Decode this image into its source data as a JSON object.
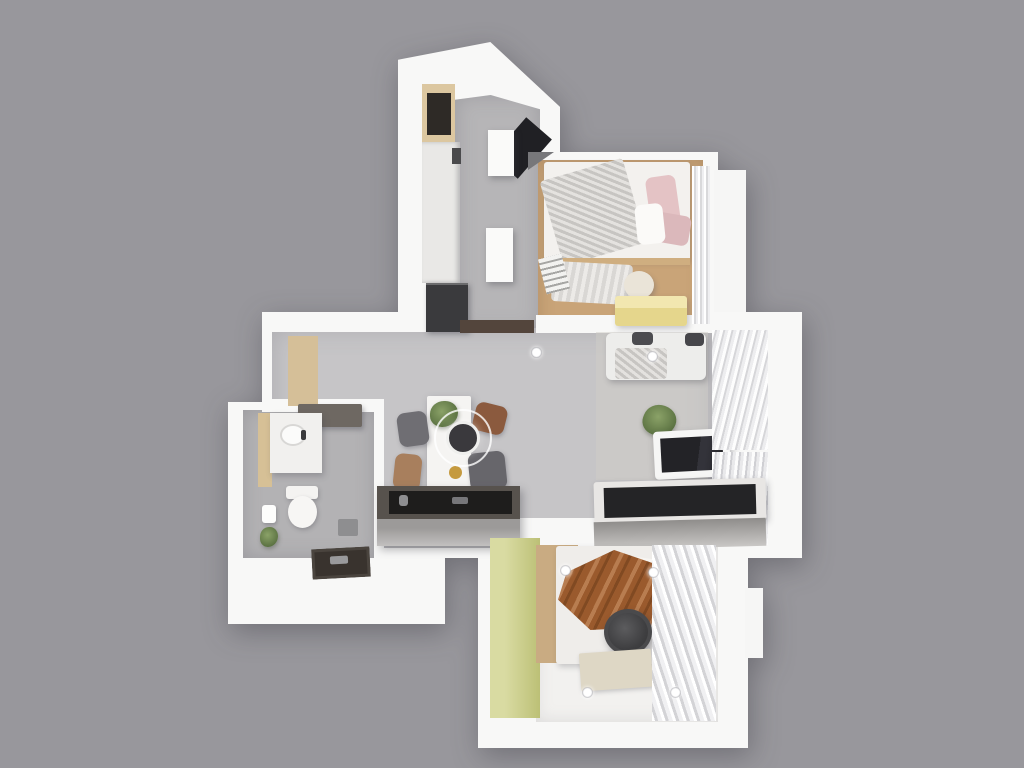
{
  "meta": {
    "type": "3d-floorplan-render",
    "description": "Top-down 3D render of a small apartment floor plan on a plain gray background",
    "canvas_width": 1024,
    "canvas_height": 768,
    "background_color": "#98979c"
  },
  "palette": {
    "background": "#98979c",
    "wall_white": "#f8f8f7",
    "floor_marble_gray": "#c6c5c7",
    "floor_marble_dark": "#b3b2b4",
    "floor_wood": "#c9a478",
    "floor_white_boards": "#f2f1ef",
    "accent_green_wall": "#bcc076",
    "accent_yellow_bench": "#e5d68c",
    "accent_pink_pillow": "#e4c3c5",
    "accent_brown_throw": "#9a5a2d",
    "dark_appliance": "#3a3a3d",
    "counter_dark_top": "#57524d",
    "gold_dish": "#c59a3f"
  },
  "rooms": [
    "kitchen",
    "bedroom-1",
    "living-dining",
    "entry",
    "bathroom",
    "bedroom-2"
  ],
  "scene": {
    "elements": [
      {
        "name": "kitchen-block",
        "rect": [
          398,
          42,
          162,
          295
        ],
        "bg": "#f8f8f7",
        "clip": "polygon(0 6%, 57% 0, 100% 22%, 100% 100%, 0 100%)"
      },
      {
        "name": "bedroom1-block",
        "rect": [
          528,
          152,
          190,
          188
        ],
        "bg": "#f8f8f7"
      },
      {
        "name": "bedroom1-side-step",
        "rect": [
          714,
          170,
          32,
          165
        ],
        "bg": "#f6f6f5"
      },
      {
        "name": "living-block",
        "rect": [
          262,
          312,
          540,
          246
        ],
        "bg": "#f8f8f7"
      },
      {
        "name": "bathroom-block",
        "rect": [
          228,
          402,
          217,
          222
        ],
        "bg": "#f8f8f7"
      },
      {
        "name": "bedroom2-block",
        "rect": [
          478,
          528,
          270,
          220
        ],
        "bg": "#f8f8f7"
      },
      {
        "name": "bedroom2-side-step",
        "rect": [
          745,
          588,
          18,
          70
        ],
        "bg": "#f6f6f5"
      },
      {
        "name": "kitchen-floor",
        "rect": [
          455,
          95,
          85,
          237
        ],
        "bg": "#b6b5b7",
        "cls": "marble",
        "clip": "polygon(0 2%, 42% 0, 100% 6%, 100% 100%, 0 100%)",
        "shadow": "inset 0 0 20px rgba(110,110,118,.35)"
      },
      {
        "name": "living-floor",
        "rect": [
          272,
          328,
          440,
          220
        ],
        "bg": "#c6c5c7",
        "cls": "tiles",
        "clip": "polygon(0 0,100% 0,100% 100%,25% 100%,25% 35%,0 35%)",
        "shadow": "inset 0 0 26px rgba(110,110,118,.3)"
      },
      {
        "name": "bathroom-floor",
        "rect": [
          243,
          410,
          132,
          148
        ],
        "bg": "#b3b2b4",
        "cls": "marble",
        "shadow": "inset 0 0 18px rgba(110,110,118,.35)"
      },
      {
        "name": "bedroom1-floor",
        "rect": [
          538,
          160,
          165,
          172
        ],
        "bg": "#c9a478",
        "cls": "planks",
        "shadow": "inset 0 0 16px rgba(120,90,60,.3)"
      },
      {
        "name": "bedroom2-floor",
        "rect": [
          536,
          544,
          182,
          178
        ],
        "bg": "#f2f1ef",
        "cls": "stripes-h",
        "shadow": "inset 0 0 16px rgba(150,150,155,.25)"
      },
      {
        "name": "wall-corridor-left",
        "rect": [
          262,
          315,
          196,
          17
        ],
        "bg": "#f8f8f7"
      },
      {
        "name": "wall-corridor-right",
        "rect": [
          536,
          315,
          192,
          18
        ],
        "bg": "#f8f8f7"
      },
      {
        "name": "wall-entry-bathroom",
        "rect": [
          262,
          399,
          122,
          13
        ],
        "bg": "#f8f8f7"
      },
      {
        "name": "wall-bathroom-living",
        "rect": [
          374,
          404,
          10,
          156
        ],
        "bg": "#f8f8f7"
      },
      {
        "name": "wall-bedroom2-door",
        "rect": [
          516,
          518,
          82,
          30
        ],
        "bg": "#f8f8f7"
      },
      {
        "name": "kitchen-wood-shelf",
        "rect": [
          422,
          84,
          33,
          58
        ],
        "bg": "#dcc7a0"
      },
      {
        "name": "kitchen-shelf-rack",
        "rect": [
          427,
          93,
          24,
          42
        ],
        "bg": "#2e2a26",
        "cls": "rack"
      },
      {
        "name": "kitchen-tall-cabinet",
        "rect": [
          422,
          142,
          38,
          141
        ],
        "bg": "#e9e8e6",
        "cls": "shelf-lines"
      },
      {
        "name": "kitchen-cabinet-handle",
        "rect": [
          452,
          148,
          9,
          16
        ],
        "bg": "#4a4a4c"
      },
      {
        "name": "kitchen-fridge",
        "rect": [
          426,
          283,
          42,
          49
        ],
        "bg": "#3a3a3d",
        "shadow": "inset 0 2px 0 rgba(255,255,255,.25), 2px 2px 5px rgba(60,60,70,.4)"
      },
      {
        "name": "kitchen-wall-oven-panel",
        "rect": [
          505,
          122,
          34,
          52
        ],
        "bg": "#202024",
        "rotate": 41
      },
      {
        "name": "kitchen-island-upper",
        "rect": [
          488,
          130,
          26,
          46
        ],
        "bg": "#fafaf9",
        "shadow": "2px 3px 6px rgba(60,60,70,.35)"
      },
      {
        "name": "kitchen-island-lower",
        "rect": [
          486,
          228,
          27,
          54
        ],
        "bg": "#fafaf9",
        "shadow": "2px 3px 6px rgba(60,60,70,.35)"
      },
      {
        "name": "kitchen-threshold",
        "rect": [
          460,
          320,
          74,
          13
        ],
        "bg": "#53453c"
      },
      {
        "name": "bedroom1-corner-shadow",
        "rect": [
          528,
          152,
          26,
          18
        ],
        "bg": "#77777a",
        "clip": "polygon(0 0,100% 0,0 100%)"
      },
      {
        "name": "bed-1",
        "rect": [
          544,
          162,
          146,
          100
        ],
        "bg": "#f3f1ee",
        "radius": "3px",
        "shadow": "1px 2px 5px rgba(80,80,90,.25)"
      },
      {
        "name": "bed1-knit-throw",
        "rect": [
          550,
          168,
          86,
          88
        ],
        "cls": "knit",
        "rotate": -16,
        "radius": "4px"
      },
      {
        "name": "bed1-pillow-pink",
        "rect": [
          648,
          176,
          30,
          50
        ],
        "bg": "#e4c3c5",
        "radius": "7px",
        "rotate": -8
      },
      {
        "name": "bed1-pillow-pink-2",
        "rect": [
          654,
          214,
          36,
          30
        ],
        "bg": "#dbb8bb",
        "radius": "7px",
        "rotate": 10
      },
      {
        "name": "bed1-pillow-white",
        "rect": [
          636,
          204,
          28,
          40
        ],
        "bg": "#fbfaf8",
        "radius": "7px",
        "rotate": -6
      },
      {
        "name": "bed1-foot-rail",
        "rect": [
          544,
          258,
          146,
          7
        ],
        "bg": "#cfae80"
      },
      {
        "name": "bed1-drape",
        "rect": [
          552,
          263,
          80,
          40
        ],
        "cls": "knit-light",
        "rotate": 3,
        "radius": "4px"
      },
      {
        "name": "bed1-ladder",
        "rect": [
          542,
          256,
          24,
          36
        ],
        "cls": "ladder",
        "rotate": -14
      },
      {
        "name": "bedroom1-pouf",
        "rect": [
          624,
          271,
          30,
          28
        ],
        "bg": "#eae4d8",
        "radius": "50%",
        "shadow": "2px 3px 5px rgba(90,90,100,.3)"
      },
      {
        "name": "bedroom1-bench",
        "rect": [
          615,
          296,
          72,
          30
        ],
        "bg": "linear-gradient(180deg,#f2e7b0 0 40%,#e5d68c 40%)",
        "radius": "3px",
        "shadow": "2px 3px 6px rgba(90,90,100,.3)"
      },
      {
        "name": "bedroom1-curtain",
        "rect": [
          692,
          166,
          18,
          158
        ],
        "cls": "curtain-v"
      },
      {
        "name": "entry-wood-panel",
        "rect": [
          288,
          336,
          30,
          70
        ],
        "bg": "#d5bf98",
        "cls": "wood-grain"
      },
      {
        "name": "entry-console",
        "rect": [
          298,
          404,
          64,
          23
        ],
        "bg": "#6e6862",
        "radius": "2px",
        "shadow": "2px 3px 5px rgba(70,70,80,.35)"
      },
      {
        "name": "living-rug",
        "rect": [
          596,
          332,
          112,
          148
        ],
        "bg": "rgba(208,205,199,.5)",
        "cls": "rug-texture"
      },
      {
        "name": "dining-table",
        "rect": [
          427,
          396,
          44,
          112
        ],
        "bg": "#f5f4f2",
        "radius": "2px",
        "shadow": "2px 3px 8px rgba(70,70,80,.35)"
      },
      {
        "name": "dining-plant",
        "rect": [
          430,
          401,
          28,
          26
        ],
        "cls": "plant"
      },
      {
        "name": "dining-gold-dish",
        "rect": [
          449,
          466,
          13,
          13
        ],
        "bg": "#c59a3f",
        "radius": "50%"
      },
      {
        "name": "dining-chair-nw",
        "rect": [
          398,
          412,
          30,
          34
        ],
        "bg": "#6f6e73",
        "radius": "8px",
        "rotate": -8,
        "shadow": "1px 2px 4px rgba(70,70,80,.35)"
      },
      {
        "name": "dining-chair-sw",
        "rect": [
          394,
          454,
          27,
          36
        ],
        "bg": "#a87f5d",
        "radius": "8px",
        "rotate": 6,
        "shadow": "1px 2px 4px rgba(70,70,80,.35)"
      },
      {
        "name": "dining-chair-ne",
        "rect": [
          474,
          404,
          32,
          29
        ],
        "bg": "#8b5a3e",
        "radius": "8px",
        "rotate": 14,
        "shadow": "1px 2px 4px rgba(70,70,80,.35)"
      },
      {
        "name": "dining-chair-se",
        "rect": [
          469,
          452,
          37,
          38
        ],
        "bg": "#67666b",
        "radius": "8px",
        "rotate": -6,
        "shadow": "1px 2px 4px rgba(70,70,80,.35)"
      },
      {
        "name": "pendant-ring",
        "rect": [
          434,
          409,
          58,
          58
        ],
        "radius": "50%",
        "border": "2px solid rgba(255,255,255,.8)"
      },
      {
        "name": "pendant-lamp",
        "rect": [
          446,
          421,
          34,
          34
        ],
        "bg": "#3a393d",
        "radius": "50%",
        "border": "3px solid #efefed",
        "shadow": "0 0 8px rgba(255,255,255,.4)"
      },
      {
        "name": "kitchen-counter",
        "rect": [
          377,
          486,
          143,
          60
        ],
        "bg": "linear-gradient(180deg,#57524d 0 55%,#9c9a99 55% 70%,#c2c0bf)",
        "shadow": "3px 4px 8px rgba(60,60,70,.35)"
      },
      {
        "name": "counter-recess",
        "rect": [
          389,
          491,
          123,
          23
        ],
        "bg": "#1e1d1c"
      },
      {
        "name": "counter-item-round",
        "rect": [
          399,
          495,
          9,
          11
        ],
        "bg": "#8e8e90",
        "radius": "3px"
      },
      {
        "name": "counter-item-tray",
        "rect": [
          452,
          497,
          16,
          7
        ],
        "bg": "#77777a",
        "radius": "2px"
      },
      {
        "name": "sofa",
        "rect": [
          606,
          333,
          100,
          47
        ],
        "bg": "#ededeb",
        "radius": "6px",
        "shadow": "2px 3px 6px rgba(70,70,80,.3)"
      },
      {
        "name": "sofa-cushion-dark-left",
        "rect": [
          632,
          332,
          21,
          13
        ],
        "bg": "#4c4c50",
        "radius": "4px"
      },
      {
        "name": "sofa-cushion-dark-right",
        "rect": [
          685,
          333,
          19,
          13
        ],
        "bg": "#46464a",
        "radius": "4px"
      },
      {
        "name": "sofa-knit-blanket",
        "rect": [
          615,
          348,
          52,
          31
        ],
        "cls": "knit",
        "radius": "4px"
      },
      {
        "name": "living-plant",
        "rect": [
          643,
          405,
          33,
          31
        ],
        "cls": "plant",
        "rotate": 20
      },
      {
        "name": "tv-stand",
        "rect": [
          654,
          430,
          76,
          48
        ],
        "bg": "#f6f6f5",
        "radius": "4px",
        "rotate": -3,
        "shadow": "2px 4px 8px rgba(60,60,70,.35)"
      },
      {
        "name": "tv-screen",
        "rect": [
          661,
          437,
          62,
          34
        ],
        "bg": "linear-gradient(100deg,#232327 0 60%,#33333a 60% 70%,#232327)",
        "rotate": -3
      },
      {
        "name": "living-curtain-upper",
        "rect": [
          712,
          330,
          56,
          120
        ],
        "cls": "curtain-d"
      },
      {
        "name": "living-curtain-lower",
        "rect": [
          712,
          452,
          56,
          93
        ],
        "cls": "curtain-d2"
      },
      {
        "name": "wardrobe-top",
        "rect": [
          594,
          480,
          172,
          42
        ],
        "bg": "#e8e6e4",
        "radius": "3px",
        "rotate": -1.5,
        "shadow": "2px 3px 7px rgba(60,60,70,.3)"
      },
      {
        "name": "wardrobe-rail-recess",
        "rect": [
          604,
          486,
          152,
          30
        ],
        "bg": "#242426",
        "cls": "clothes",
        "rotate": -1.5
      },
      {
        "name": "wardrobe-front",
        "rect": [
          594,
          520,
          172,
          28
        ],
        "bg": "linear-gradient(180deg,#8f8d8b,#c9c7c5)",
        "rotate": -1.5
      },
      {
        "name": "bedroom2-green-wall",
        "rect": [
          490,
          538,
          50,
          180
        ],
        "bg": "linear-gradient(90deg,#d9dba2 0 30%,#bcc076)"
      },
      {
        "name": "bedroom2-wood-panel",
        "rect": [
          536,
          545,
          42,
          118
        ],
        "bg": "#c9ab82",
        "cls": "wood-grain"
      },
      {
        "name": "bed-2",
        "rect": [
          556,
          546,
          112,
          118
        ],
        "bg": "#efedea",
        "radius": "3px",
        "shadow": "2px 3px 6px rgba(70,70,80,.25)"
      },
      {
        "name": "bed2-sheets",
        "rect": [
          618,
          558,
          48,
          62
        ],
        "bg": "#f7f5f2",
        "radius": "8px",
        "rotate": 8
      },
      {
        "name": "bed2-brown-throw",
        "rect": [
          558,
          550,
          108,
          80
        ],
        "cls": "folds-brown",
        "clip": "polygon(8% 28%, 52% 0, 100% 22%, 86% 96%, 30% 100%, 0 62%)"
      },
      {
        "name": "bed2-round-stool",
        "rect": [
          604,
          609,
          48,
          46
        ],
        "bg": "radial-gradient(circle at 42% 40%, #5c5c5e, #3e3e40 65%, #343436)",
        "radius": "50%",
        "border": "4px solid #4a4a4c",
        "shadow": "3px 4px 8px rgba(50,50,60,.4)"
      },
      {
        "name": "bedroom2-rug",
        "rect": [
          580,
          651,
          72,
          38
        ],
        "bg": "#ded7c5",
        "rotate": -4,
        "radius": "2px",
        "shadow": "1px 2px 4px rgba(90,90,95,.3)"
      },
      {
        "name": "bedroom2-curtain",
        "rect": [
          652,
          545,
          64,
          176
        ],
        "cls": "curtain-d3"
      },
      {
        "name": "vanity-side",
        "rect": [
          258,
          413,
          14,
          74
        ],
        "bg": "#d6c096"
      },
      {
        "name": "vanity-top",
        "rect": [
          270,
          413,
          52,
          60
        ],
        "bg": "#f1f0ee",
        "cls": "marble",
        "shadow": "2px 3px 6px rgba(70,70,80,.3)"
      },
      {
        "name": "vanity-sink",
        "rect": [
          280,
          424,
          26,
          22
        ],
        "bg": "#fbfbfa",
        "radius": "50%",
        "border": "2px solid #d8d7d5"
      },
      {
        "name": "vanity-faucet",
        "rect": [
          301,
          430,
          5,
          10
        ],
        "bg": "#3a3a3c",
        "radius": "2px"
      },
      {
        "name": "toilet-tank",
        "rect": [
          286,
          486,
          32,
          13
        ],
        "bg": "#f4f3f1",
        "radius": "3px",
        "shadow": "1px 2px 4px rgba(70,70,80,.3)"
      },
      {
        "name": "toilet-bowl",
        "rect": [
          288,
          496,
          29,
          32
        ],
        "bg": "#f7f6f4",
        "radius": "50%",
        "shadow": "1px 2px 4px rgba(70,70,80,.3)"
      },
      {
        "name": "toilet-paper-holder",
        "rect": [
          262,
          505,
          14,
          18
        ],
        "bg": "#fdfdfc",
        "radius": "3px",
        "shadow": "1px 2px 3px rgba(70,70,80,.3)"
      },
      {
        "name": "bathroom-plant",
        "rect": [
          260,
          527,
          18,
          20
        ],
        "cls": "plant"
      },
      {
        "name": "shower-mixer",
        "rect": [
          338,
          519,
          20,
          17
        ],
        "bg": "#8e8e90",
        "radius": "2px"
      },
      {
        "name": "shower-tray",
        "rect": [
          312,
          548,
          58,
          30
        ],
        "bg": "#39332e",
        "rotate": -3,
        "shadow": "inset 0 0 0 3px #4a443e"
      },
      {
        "name": "shower-tray-fitting",
        "rect": [
          330,
          556,
          18,
          8
        ],
        "bg": "#9a9a9c",
        "rotate": -3,
        "radius": "2px"
      },
      {
        "name": "ceiling-light-living-1",
        "rect": [
          531,
          347,
          11,
          11
        ],
        "cls": "ceiling-light"
      },
      {
        "name": "ceiling-light-living-2",
        "rect": [
          647,
          351,
          11,
          11
        ],
        "cls": "ceiling-light"
      },
      {
        "name": "ceiling-light-bedroom2-1",
        "rect": [
          560,
          565,
          11,
          11
        ],
        "cls": "ceiling-light"
      },
      {
        "name": "ceiling-light-bedroom2-2",
        "rect": [
          648,
          567,
          11,
          11
        ],
        "cls": "ceiling-light"
      },
      {
        "name": "ceiling-light-bedroom2-3",
        "rect": [
          582,
          687,
          11,
          11
        ],
        "cls": "ceiling-light"
      },
      {
        "name": "ceiling-light-bedroom2-4",
        "rect": [
          670,
          687,
          11,
          11
        ],
        "cls": "ceiling-light"
      }
    ]
  }
}
